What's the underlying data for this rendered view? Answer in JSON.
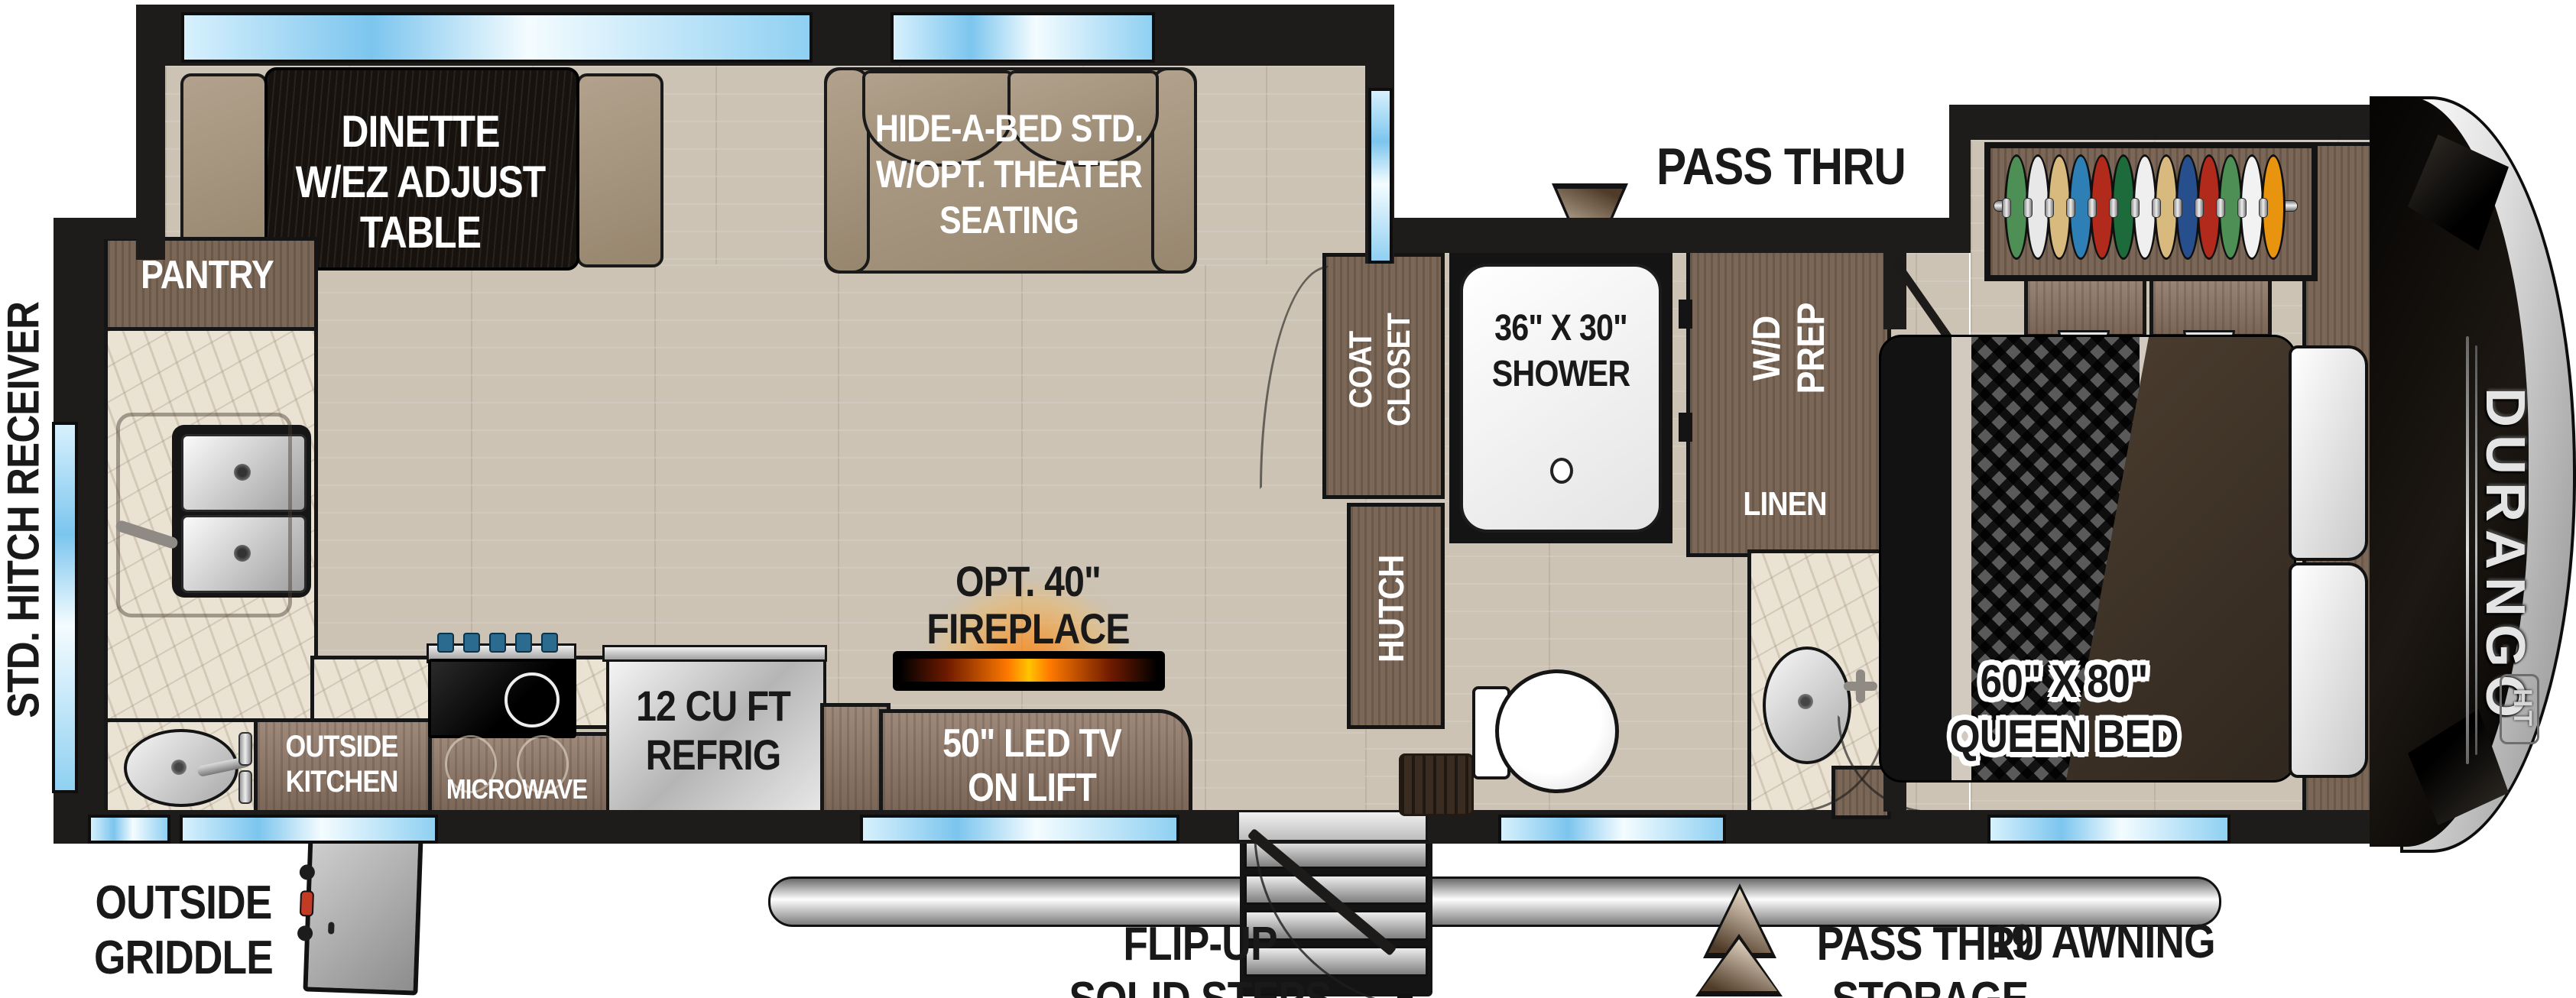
{
  "title": "Fifth wheel travel trailer floorplan",
  "brand": {
    "name": "DURANGO",
    "series": "HT"
  },
  "exterior_labels": {
    "hitch": [
      "STD. HITCH RECEIVER",
      "W/4-PIN HARNESS"
    ],
    "pass_thru_front": [
      "PASS THRU",
      "STORAGE"
    ],
    "pass_thru_rear": [
      "PASS THRU",
      "STORAGE"
    ],
    "awning": "19' AWNING",
    "steps": [
      "FLIP-UP",
      "SOLID STEPS"
    ],
    "griddle": [
      "OUTSIDE",
      "GRIDDLE"
    ]
  },
  "rooms": {
    "dinette": [
      "DINETTE",
      "W/EZ ADJUST",
      "TABLE"
    ],
    "sofa": [
      "HIDE-A-BED STD.",
      "W/OPT. THEATER",
      "SEATING"
    ],
    "pantry": "PANTRY",
    "coat_closet": [
      "COAT",
      "CLOSET"
    ],
    "shower": [
      "36\" X 30\"",
      "SHOWER"
    ],
    "wd_prep": [
      "W/D",
      "PREP"
    ],
    "linen": "LINEN",
    "hutch": "HUTCH",
    "fireplace": [
      "OPT. 40\"",
      "FIREPLACE"
    ],
    "tv": [
      "50\" LED TV",
      "ON LIFT"
    ],
    "refrigerator": [
      "12 CU FT",
      "REFRIG"
    ],
    "outside_kitchen": [
      "OUTSIDE",
      "KITCHEN"
    ],
    "microwave": "MICROWAVE",
    "queen_bed": [
      "60\" X 80\"",
      "QUEEN BED"
    ]
  },
  "closet": {
    "hanger_colors": [
      "#4e8f55",
      "#e8e8e8",
      "#d8b97e",
      "#2e7fb5",
      "#b22a1c",
      "#1d6a3a",
      "#efefef",
      "#d8b97e",
      "#274f8e",
      "#b22a1c",
      "#4e8f55",
      "#f2f2f2",
      "#e8940f"
    ]
  },
  "colors": {
    "wall": "#1d1c1a",
    "floor_wood": "#cdc3b4",
    "cabinet_wood": "#8d7564",
    "upholstery_tan": "#a5947f",
    "window_blue": "#7cc5ee",
    "counter_marble": "#eae2d3",
    "stainless": "#d6d6d6",
    "fireplace_glow": "#ff7a00",
    "front_cap": "#0b0907"
  }
}
